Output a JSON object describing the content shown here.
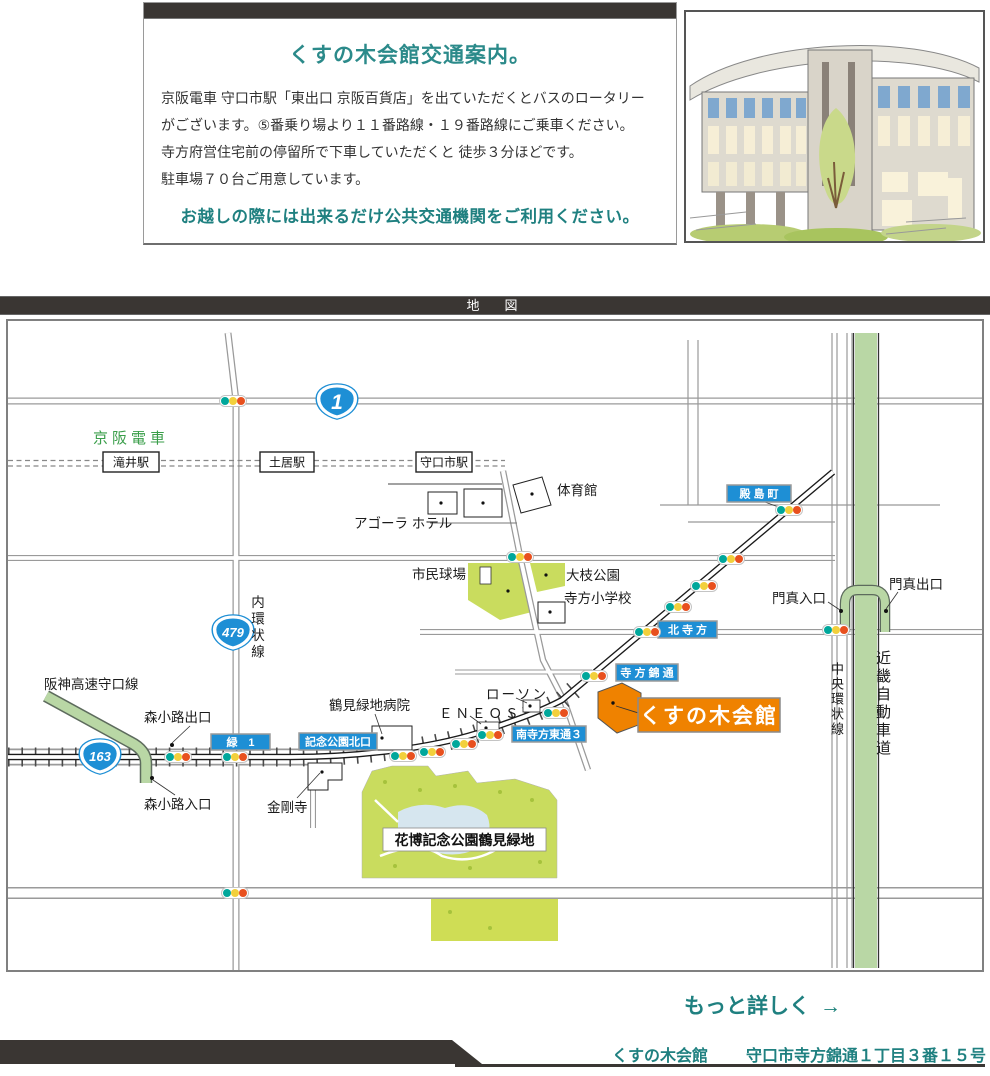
{
  "colors": {
    "bar_dark": "#3a3633",
    "accent_teal": "#1f8080",
    "title_teal": "#2b8a8a",
    "sign_blue": "#1e8fd5",
    "venue_orange": "#ef8200",
    "park_green": "#c9dc5e",
    "expressway_green": "#b9d7a5",
    "railway_text_green": "#3a9e4a",
    "traffic_light_teal": "#00a79b",
    "traffic_light_yellow": "#f2d03c",
    "traffic_light_red": "#e8501e"
  },
  "header": {
    "title": "くすの木会館交通案内。",
    "lines": [
      "京阪電車 守口市駅「東出口 京阪百貨店」を出ていただくとバスのロータリー",
      "がございます。⑤番乗り場より１１番路線・１９番路線にご乗車ください。",
      "寺方府営住宅前の停留所で下車していただくと 徒歩３分ほどです。",
      "駐車場７０台ご用意しています。"
    ],
    "note": "お越しの際には出来るだけ公共交通機関をご利用ください。"
  },
  "map_bar": {
    "label": "地　図"
  },
  "map": {
    "railway_name": "京阪電車",
    "stations": {
      "takii": "滝井駅",
      "doi": "土居駅",
      "moriguchi": "守口市駅"
    },
    "routes": {
      "r1": "1",
      "r479": "479",
      "r163": "163"
    },
    "roads": {
      "uchi_kanjo": "内環状線",
      "chuo_kanjo": "中央環状線",
      "kinki_expwy": "近畿自動車道",
      "hanshin_expwy": "阪神高速守口線"
    },
    "signs": {
      "tonoshima": "殿 島 町",
      "kita_terakata": "北 寺 方",
      "terakata_nishiki": "寺 方 錦 通",
      "minami_terakata_higashi": "南寺方東通３",
      "midori1": "緑　1",
      "kinen_koen_kitaguchi": "記念公園北口"
    },
    "places": {
      "gym": "体育館",
      "agora_hotel": "アゴーラ ホテル",
      "ballpark": "市民球場",
      "oeda_park": "大枝公園",
      "terakata_elementary": "寺方小学校",
      "lawson": "ローソン",
      "eneos": "ＥＮＥＯＳ",
      "tsurumi_hospital": "鶴見緑地病院",
      "kongoji": "金剛寺",
      "kahaku_park": "花博記念公園鶴見緑地"
    },
    "ramps": {
      "morishoji_exit": "森小路出口",
      "morishoji_entrance": "森小路入口",
      "kadoma_entrance": "門真入口",
      "kadoma_exit": "門真出口"
    },
    "venue": {
      "name": "くすの木会館"
    }
  },
  "footer": {
    "more": "もっと詳しく",
    "arrow": "→",
    "name": "くすの木会館",
    "address": "守口市寺方錦通１丁目３番１５号"
  }
}
